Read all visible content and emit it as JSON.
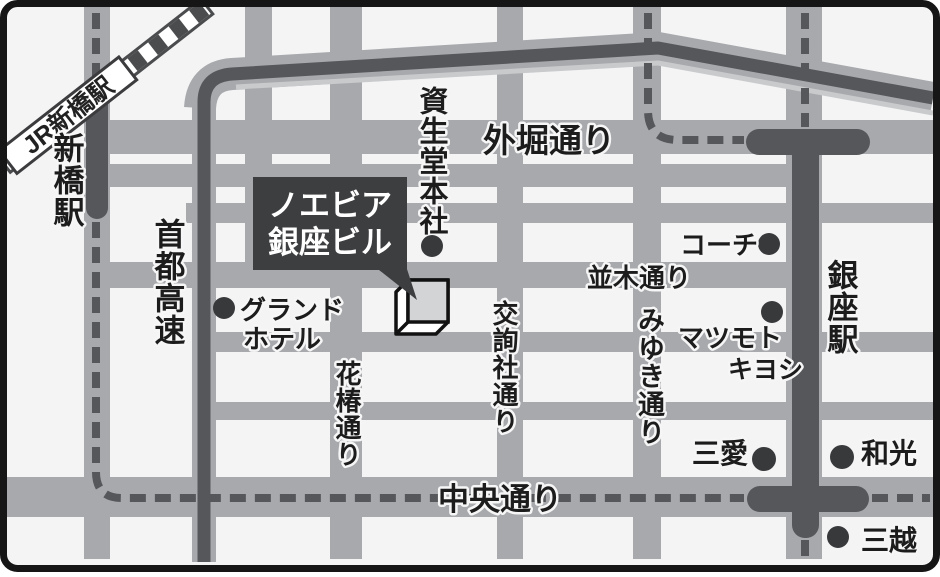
{
  "map": {
    "jr_line_label": "JR新橋駅",
    "stations": {
      "shimbashi": "新橋駅",
      "ginza": "銀座駅"
    },
    "roads": {
      "sotobori": "外堀通り",
      "shuto_expressway": "首都高速",
      "namiki": "並木通り",
      "miyuki": "みゆき通り",
      "hanatsubaki": "花椿通り",
      "kojunsha": "交詢社通り",
      "chuo": "中央通り"
    },
    "destination": {
      "line1": "ノエビア",
      "line2": "銀座ビル"
    },
    "landmarks": {
      "shiseido": "資生堂本社",
      "grand_hotel_line1": "グランド",
      "grand_hotel_line2": "ホテル",
      "coach": "コーチ",
      "matsumoto_line1": "マツモト",
      "matsumoto_line2": "キヨシ",
      "sanai": "三愛",
      "wako": "和光",
      "mitsukoshi": "三越"
    },
    "colors": {
      "street_gray": "#a7a9ac",
      "dark_road": "#55575a",
      "block_white": "#f4f4f5",
      "callout_bg": "#3d3e40",
      "border_black": "#161616",
      "dot": "#38393b"
    }
  }
}
